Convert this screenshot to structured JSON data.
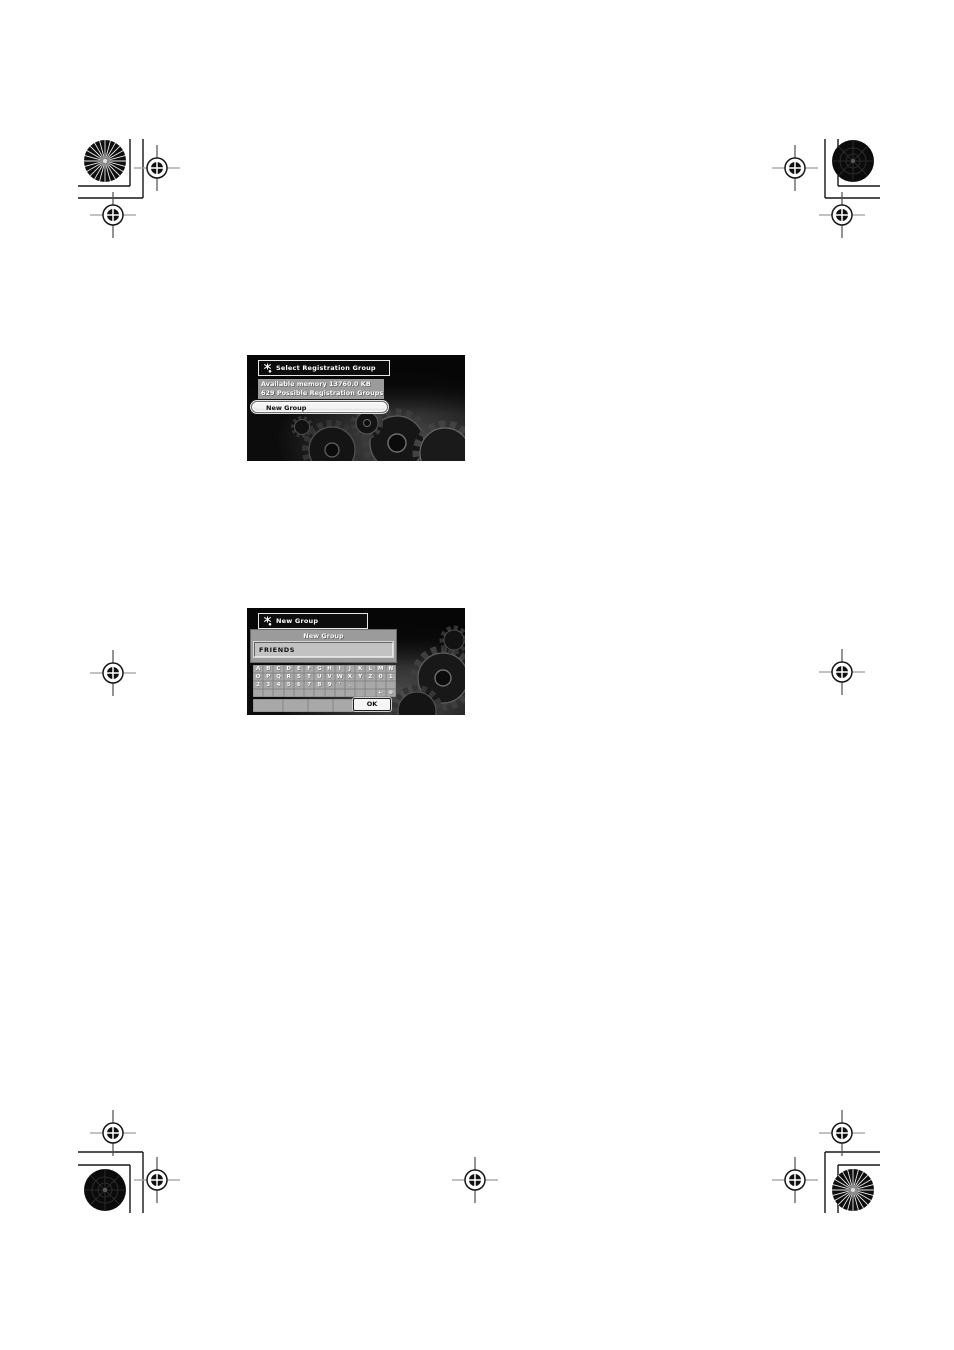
{
  "colors": {
    "screen_background": "#0a0a0a",
    "panel_gray": "#9b9b9b",
    "key_gray": "#a8a8a8",
    "highlight_white": "#f4f4f4",
    "text_white": "#ffffff",
    "text_black": "#0c0c0c"
  },
  "icons": {
    "title_icon": "key-icon",
    "registration_target": "crosshair-target-icon",
    "top_left_wheel": "starburst-circle-icon",
    "top_right_wheel": "dark-circle-icon"
  },
  "screen1": {
    "title": "Select Registration Group",
    "info_line1": "Available memory 13760.0 KB",
    "info_line2": "629 Possible Registration Groups",
    "new_group_button": "New Group"
  },
  "screen2": {
    "title": "New Group",
    "panel_header": "New Group",
    "input_value": "FRIENDS",
    "keyboard": {
      "row1": [
        "A",
        "B",
        "C",
        "D",
        "E",
        "F",
        "G",
        "H",
        "I",
        "J",
        "K",
        "L",
        "M",
        "N"
      ],
      "row2": [
        "O",
        "P",
        "Q",
        "R",
        "S",
        "T",
        "U",
        "V",
        "W",
        "X",
        "Y",
        "Z",
        "0",
        "1"
      ],
      "row3": [
        "2",
        "3",
        "4",
        "5",
        "6",
        "7",
        "8",
        "9",
        "'",
        ".",
        "",
        "",
        "",
        ""
      ],
      "row4": [
        "",
        "",
        "",
        "",
        "",
        "",
        "",
        "",
        "",
        "",
        "",
        "",
        "←",
        "⊗"
      ],
      "space_row": [
        "",
        "",
        "",
        ""
      ],
      "ok_button": "OK"
    }
  }
}
